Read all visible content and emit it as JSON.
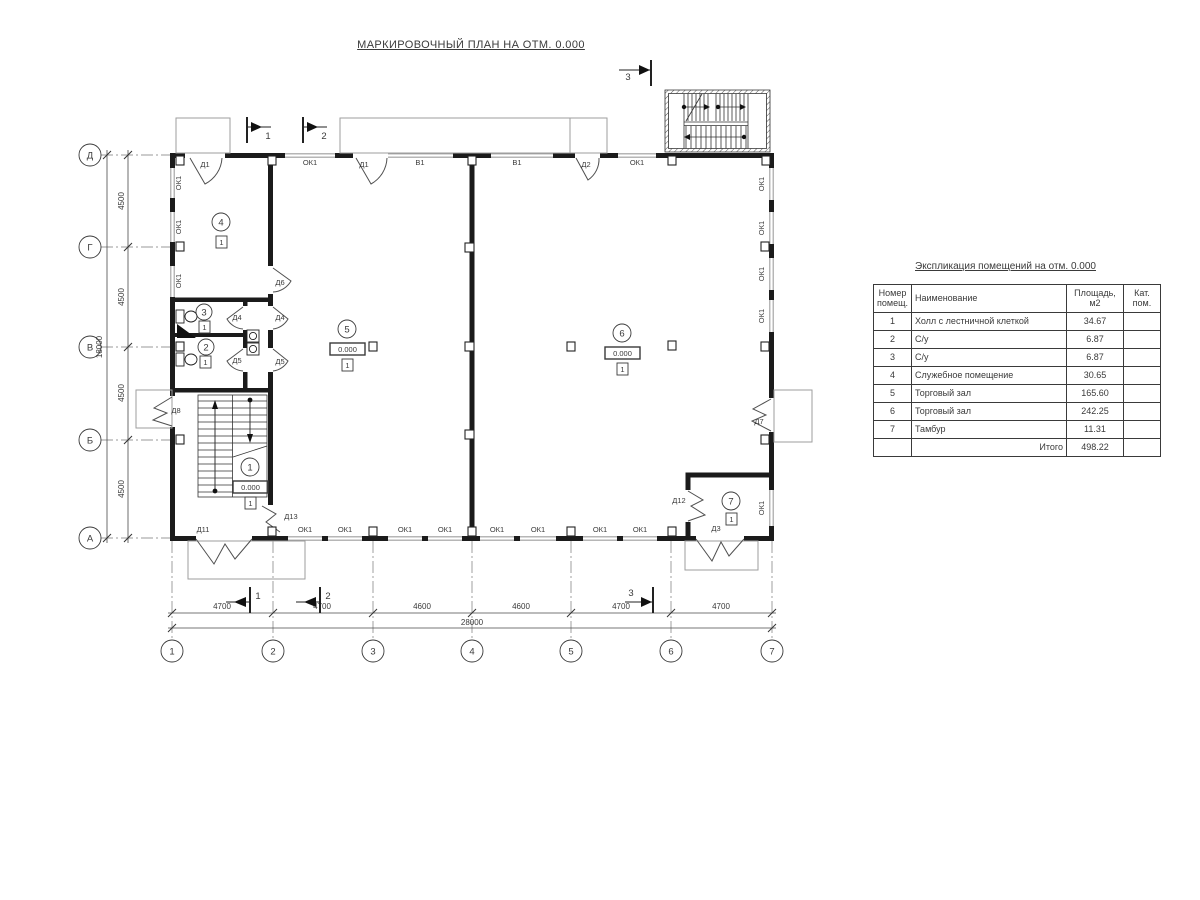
{
  "title": "МАРКИРОВОЧНЫЙ ПЛАН НА ОТМ. 0.000",
  "table": {
    "title": "Экспликация помещений на отм. 0.000",
    "col_headers": {
      "num": "Номер помещ.",
      "name": "Наименование",
      "area": "Площадь, м2",
      "cat": "Кат. пом."
    },
    "rows": [
      {
        "num": "1",
        "name": "Холл с лестничной клеткой",
        "area": "34.67",
        "cat": ""
      },
      {
        "num": "2",
        "name": "С/у",
        "area": "6.87",
        "cat": ""
      },
      {
        "num": "3",
        "name": "С/у",
        "area": "6.87",
        "cat": ""
      },
      {
        "num": "4",
        "name": "Служебное помещение",
        "area": "30.65",
        "cat": ""
      },
      {
        "num": "5",
        "name": "Торговый зал",
        "area": "165.60",
        "cat": ""
      },
      {
        "num": "6",
        "name": "Торговый зал",
        "area": "242.25",
        "cat": ""
      },
      {
        "num": "7",
        "name": "Тамбур",
        "area": "11.31",
        "cat": ""
      }
    ],
    "total_label": "Итого",
    "total_area": "498.22"
  },
  "axes": {
    "rows": [
      "Д",
      "Г",
      "В",
      "Б",
      "А"
    ],
    "cols": [
      "1",
      "2",
      "3",
      "4",
      "5",
      "6",
      "7"
    ]
  },
  "dims": {
    "left_segments": [
      "4500",
      "4500",
      "4500",
      "4500"
    ],
    "left_total": "18000",
    "bottom_segments": [
      "4700",
      "4700",
      "4600",
      "4600",
      "4700",
      "4700"
    ],
    "bottom_total": "28000"
  },
  "sections": {
    "s1": "1",
    "s2": "2",
    "s3": "3"
  },
  "labels": {
    "ok1": "ОК1",
    "v1": "В1",
    "d1": "Д1",
    "d2": "Д2",
    "d3": "Д3",
    "d4": "Д4",
    "d5": "Д5",
    "d6": "Д6",
    "d7": "Д7",
    "d8": "Д8",
    "d11": "Д11",
    "d12": "Д12",
    "d13": "Д13"
  },
  "rooms": {
    "r1": "1",
    "r2": "2",
    "r3": "3",
    "r4": "4",
    "r5": "5",
    "r6": "6",
    "r7": "7",
    "level": "0.000",
    "floor_type": "1"
  }
}
